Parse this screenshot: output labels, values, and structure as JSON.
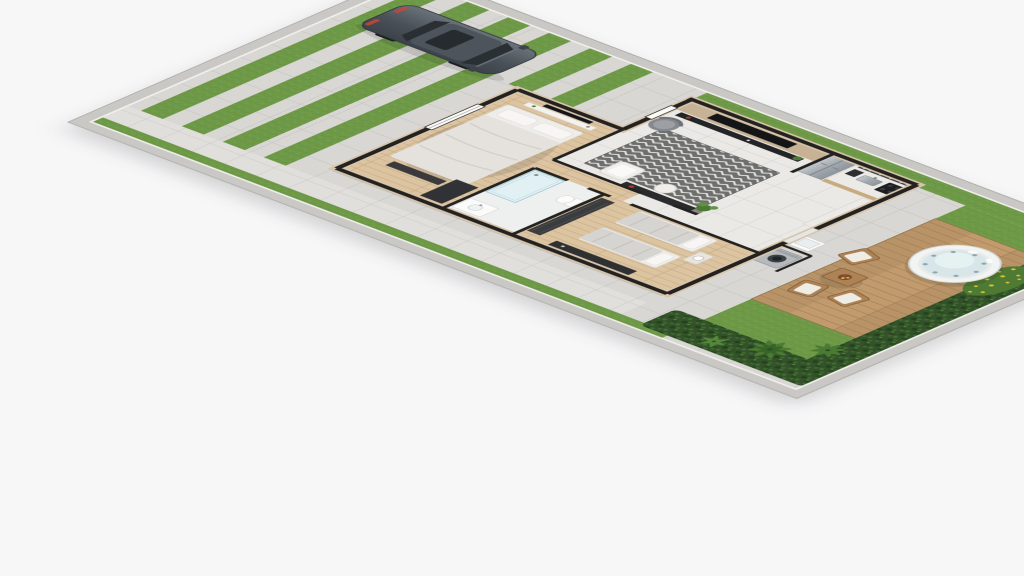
{
  "meta": {
    "title": "3D isometric floor-plan rendering of a single-story house on a narrow lot",
    "view": "aerial three-quarter cutaway",
    "visible_text": "none"
  },
  "palette": {
    "background": "#f7f7f8",
    "concrete": "#d8d7d3",
    "path": "#e0dfdb",
    "perimeter_wall": "#c9c8c5",
    "wall_black": "#232220",
    "wall_beige": "#d8c5ab",
    "grass": "#6f9a48",
    "grass_dark": "#5d873c",
    "hedge": "#33522a",
    "palm": "#4a7a33",
    "flowers": "#d6c33c",
    "deck": "#c19b6d",
    "deck_seam": "#a07a4e",
    "wood_floor": "#dcc4a1",
    "tile_floor": "#ebe9e5",
    "rug": "#6e6e6c",
    "rug_zigzag": "#e8e8e6",
    "tv_panel_wood": "#c7b295",
    "tv_black": "#141517",
    "sofa_white": "#f0eeea",
    "armchair_gray": "#85898d",
    "counter": "#eceae7",
    "cabinet_wood": "#c7aa7e",
    "steel": "#aab1b7",
    "car_body": "#4a5158",
    "car_glass": "#2a2f34",
    "bed_linen": "#e5e2dd",
    "pillow": "#f7f6f4",
    "tub_shell": "#f2f4f3",
    "tub_water": "#d8e6e9",
    "chair_wood": "#ad8256",
    "cushion": "#efece4",
    "washer": "#b7babd"
  },
  "objects": {
    "car": {
      "label": "gray sedan parked on striped driveway",
      "color": "#4a5158"
    },
    "driveway": {
      "label": "concrete driveway with grass joint strips",
      "strip_count": 6
    },
    "perimeter_wall": {
      "label": "light gray boundary wall around lot"
    },
    "front_lawn_strips": {
      "label": "grass strips between concrete pads"
    },
    "side_path": {
      "label": "concrete side passage along south wall with grass edge"
    },
    "bedroom_1": {
      "label": "master bedroom",
      "items": [
        "double bed with white duvet and two pillows",
        "wall TV with shelf",
        "foot bench",
        "corner dresser"
      ]
    },
    "living_room": {
      "label": "living room",
      "items": [
        "wood TV panel wall",
        "large TV",
        "dark media console",
        "red candle decor",
        "gray armchair",
        "chevron rug",
        "white lounge chair",
        "white pouf",
        "dark media bench",
        "potted plant"
      ]
    },
    "kitchen": {
      "label": "open kitchen",
      "items": [
        "stainless french-door fridge",
        "counter with sink",
        "coffee machine",
        "black cooktop",
        "wall shelves with utensils",
        "peninsula counter"
      ]
    },
    "bathroom": {
      "label": "bathroom",
      "items": [
        "glass shower box",
        "toilet",
        "vanity with basin"
      ]
    },
    "bedroom_2": {
      "label": "second bedroom",
      "items": [
        "two single beds with gray duvets",
        "nightstand with round lamp",
        "dark wardrobe",
        "dark media unit"
      ]
    },
    "laundry": {
      "label": "service nook",
      "items": [
        "front-load washing machine",
        "utility sink"
      ]
    },
    "backyard": {
      "label": "backyard",
      "items": [
        "concrete patio",
        "timber deck",
        "round white hot tub with jets",
        "wood coffee table with centerpiece",
        "three wood armchairs with white cushions",
        "dense hedge",
        "palm plants",
        "yellow flower bed",
        "lawn"
      ]
    }
  }
}
